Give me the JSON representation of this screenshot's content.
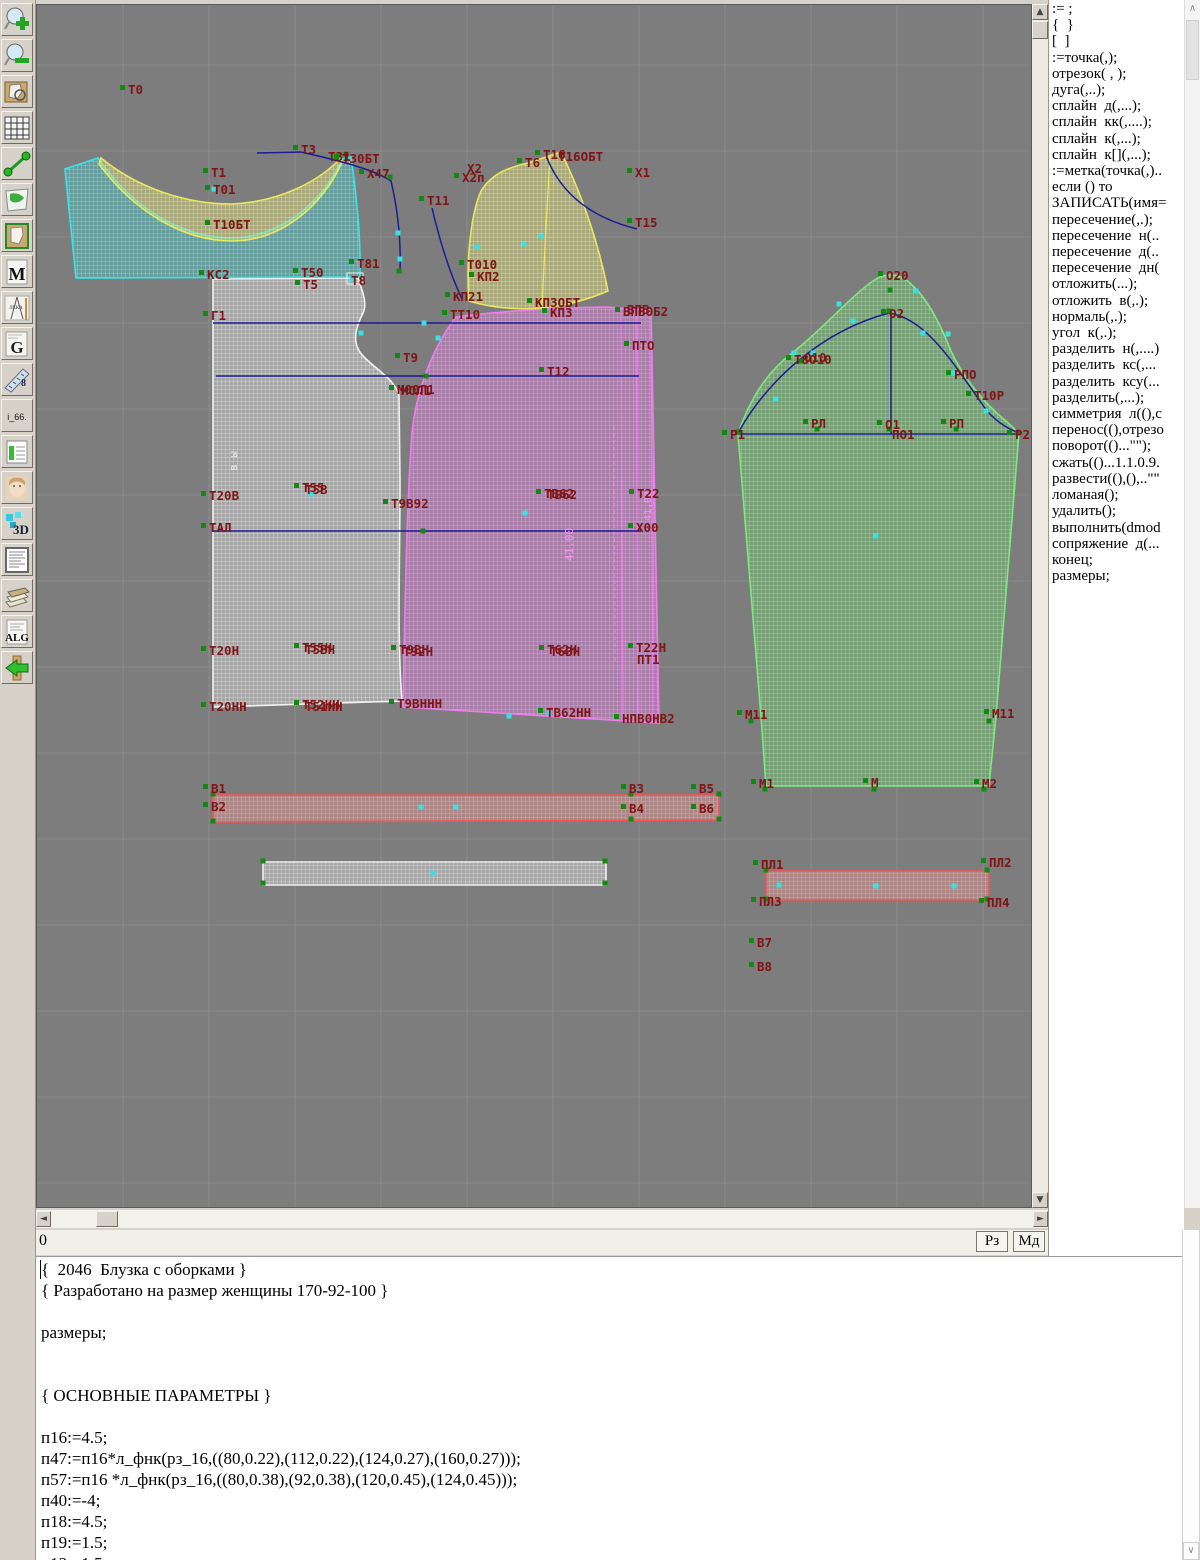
{
  "toolbar": {
    "icons": [
      {
        "name": "zoom-in-icon"
      },
      {
        "name": "zoom-out-icon"
      },
      {
        "name": "preview-icon"
      },
      {
        "name": "grid-icon"
      },
      {
        "name": "segment-icon"
      },
      {
        "name": "map-icon"
      },
      {
        "name": "pattern-icon"
      },
      {
        "name": "m-page-icon",
        "text": "M"
      },
      {
        "name": "drafting-icon"
      },
      {
        "name": "g-page-icon",
        "text": "G"
      },
      {
        "name": "ruler-icon",
        "text": "8"
      },
      {
        "name": "i66-icon",
        "text": "i_66."
      },
      {
        "name": "table-icon"
      },
      {
        "name": "photo-icon"
      },
      {
        "name": "threed-icon",
        "text": "3D"
      },
      {
        "name": "list-icon"
      },
      {
        "name": "books-icon"
      },
      {
        "name": "alg-icon",
        "text": "ALG"
      },
      {
        "name": "exit-icon"
      }
    ]
  },
  "panel": {
    "items": [
      ":= ;",
      "{  }",
      "[  ]",
      ":=точка(,);",
      "отрезок( , );",
      "дуга(,..);",
      "сплайн  д(,...);",
      "сплайн  кк(,....);",
      "сплайн  к(,...);",
      "сплайн  к[](,...);",
      ":=метка(точка(,)..",
      "если () то",
      "ЗАПИСАТЬ(имя=",
      "пересечение(,.);",
      "пересечение  н(..",
      "пересечение  д(..",
      "пересечение  дн(",
      "отложить(...);",
      "отложить  в(,.);",
      "нормаль(,.);",
      "угол  к(,.);",
      "разделить  н(,....)",
      "разделить  кс(,...",
      "разделить  ксу(...",
      "разделить(,...);",
      "симметрия  л((),с",
      "перенос((),отрезо",
      "поворот(()...\"\");",
      "сжать(()...1.1.0.9.",
      "развести((),(),..\"\"",
      "ломаная();",
      "удалить();",
      "выполнить(dmod",
      "сопряжение  д(...",
      "конец;",
      "размеры;"
    ]
  },
  "statusbar": {
    "left": "0",
    "rz": "Рз",
    "md": "Мд"
  },
  "editor": {
    "lines": [
      "{  2046  Блузка с оборками }",
      "{ Разработано на размер женщины 170-92-100 }",
      "",
      "размеры;",
      "",
      "",
      "{ ОСНОВНЫЕ ПАРАМЕТРЫ }",
      "",
      "п16:=4.5;",
      "п47:=п16*л_фнк(рз_16,((80,0.22),(112,0.22),(124,0.27),(160,0.27)));",
      "п57:=п16 *л_фнк(рз_16,((80,0.38),(92,0.38),(120,0.45),(124,0.45)));",
      "п40:=-4;",
      "п18:=4.5;",
      "п19:=1.5;",
      "п13:=1.5;"
    ]
  },
  "canvas": {
    "bg": "#7d7d7d",
    "grid": {
      "x0": 122,
      "y0": 64,
      "step": 86,
      "color": "#8b8b8b"
    },
    "label_color": "#811414",
    "point_color": "#128a12",
    "marker_color": "#39e2e2",
    "line_color": "#1c1c96",
    "pieces": [
      {
        "name": "back-piece",
        "stroke": "#f2f2f2",
        "base": "#c9c9c9",
        "mesh": "#ffffff",
        "path": "M212,278 L357,277 C363,294 366,304 362,312 C353,330 351,344 363,356 C377,370 393,378 398,394 L399,480 C399,560 396,640 401,700 L212,706 Z"
      },
      {
        "name": "front-piece",
        "stroke": "#f07df0",
        "base": "#cf7fcf",
        "mesh": "#f7bdf7",
        "path": "M455,316 C482,312 542,307 605,306 L650,309 L658,722 L402,706 C404,600 406,498 411,432 C415,390 432,346 455,316 Z"
      },
      {
        "name": "back-yoke-piece",
        "stroke": "#35e8e8",
        "base": "#4fb8b8",
        "mesh": "#aef5f5",
        "path": "M64,168 L97,157 C135,212 185,237 232,237 C280,235 322,202 341,158 L350,156 C356,198 360,240 359,276 L75,277 Z"
      },
      {
        "name": "collar-band-piece",
        "stroke": "#e8e860",
        "base": "#cfcf7a",
        "mesh": "#fafab4",
        "path": "M100,157 C138,188 186,203 230,203 C282,201 320,178 340,157 L341,161 C322,205 280,240 231,240 C184,240 134,212 98,163 Z"
      },
      {
        "name": "side-ruffle-piece",
        "stroke": "#e8e860",
        "base": "#cfcf7a",
        "mesh": "#fafab4",
        "path": "M527,162 L560,151 C580,192 597,240 607,290 C565,308 515,314 468,300 C465,258 470,213 480,190 C492,171 510,166 527,162 Z"
      },
      {
        "name": "sleeve-piece",
        "stroke": "#7fe87f",
        "base": "#6fbf6f",
        "mesh": "#b9f2b9",
        "path": "M737,433 C748,400 765,372 790,353 C820,330 850,295 872,280 C885,271 900,272 912,285 C928,300 940,325 950,350 C960,372 980,400 1005,420 L1018,432 L995,715 L988,785 L765,785 L760,715 Z"
      },
      {
        "name": "ruffle-strip-piece",
        "stroke": "#f25555",
        "base": "#d98f8f",
        "mesh": "#f7c0c0",
        "path": "M212,794 L718,794 L718,819 L212,821 Z"
      },
      {
        "name": "binding-strip-piece",
        "stroke": "#eeeeee",
        "base": "#cccccc",
        "mesh": "#f5f5f5",
        "path": "M262,861 L605,861 L605,884 L262,884 Z"
      },
      {
        "name": "cuff-strip-piece",
        "stroke": "#f25555",
        "base": "#d98f8f",
        "mesh": "#f7c0c0",
        "path": "M765,870 L988,870 L988,899 L765,899 Z"
      }
    ],
    "blue_lines": [
      [
        212,
        322,
        640,
        322
      ],
      [
        215,
        375,
        638,
        375
      ],
      [
        212,
        530,
        640,
        530
      ],
      [
        735,
        433,
        1020,
        433
      ],
      [
        890,
        312,
        890,
        433
      ],
      [
        256,
        152,
        300,
        151
      ]
    ],
    "fold_lines": {
      "color": "#f07df0",
      "solid": [
        [
          620,
          312,
          622,
          718
        ],
        [
          635,
          310,
          637,
          720
        ],
        [
          650,
          309,
          652,
          721
        ]
      ],
      "dashed": [
        [
          613,
          425,
          614,
          660
        ]
      ]
    },
    "blue_curves": [
      "M300,151 C340,160 374,169 390,180 C398,214 400,244 399,272",
      "M431,207 C440,245 450,275 461,298",
      "M546,157 C562,197 596,218 636,228",
      "M737,432 C766,380 820,330 888,312 C926,318 952,362 986,410 C998,423 1008,428 1018,432"
    ],
    "seam_curves": [
      {
        "d": "M549,154 C546,210 543,260 541,308",
        "color": "#e8e860"
      }
    ],
    "sel_rect": {
      "x": 346,
      "y": 272,
      "w": 16,
      "h": 11
    },
    "labels": [
      [
        "Т0",
        127,
        93
      ],
      [
        "Т3",
        300,
        153
      ],
      [
        "Т31",
        327,
        160,
        0
      ],
      [
        "Т30БТ",
        341,
        162
      ],
      [
        "Х47",
        366,
        177
      ],
      [
        "Т1",
        210,
        176
      ],
      [
        "Т01",
        212,
        193
      ],
      [
        "Т10БТ",
        212,
        228
      ],
      [
        "КС2",
        206,
        278
      ],
      [
        "Т50",
        300,
        276
      ],
      [
        "Т5",
        302,
        288
      ],
      [
        "Т81",
        356,
        267
      ],
      [
        "Т8",
        350,
        284,
        0
      ],
      [
        "Т6",
        524,
        166
      ],
      [
        "Т16",
        542,
        158
      ],
      [
        "Т16ОБТ",
        557,
        160,
        0
      ],
      [
        "Х2",
        466,
        172,
        0
      ],
      [
        "Х2п",
        461,
        181
      ],
      [
        "Х1",
        634,
        176
      ],
      [
        "Т11",
        426,
        204
      ],
      [
        "Т15",
        634,
        226
      ],
      [
        "Т010",
        466,
        268
      ],
      [
        "КП2",
        476,
        280
      ],
      [
        "КП21",
        452,
        300
      ],
      [
        "ТТ10",
        449,
        318
      ],
      [
        "КП3ОБТ",
        534,
        306
      ],
      [
        "КП3",
        549,
        316
      ],
      [
        "ВПВ0Б2",
        622,
        315
      ],
      [
        "ВПВ",
        626,
        313,
        0
      ],
      [
        "ПТО",
        631,
        349
      ],
      [
        "Г1",
        210,
        319
      ],
      [
        "Т9",
        402,
        361
      ],
      [
        "Т12",
        546,
        375
      ],
      [
        "М00Л1",
        396,
        393
      ],
      [
        "МОЛ1",
        400,
        394,
        0
      ],
      [
        "Т20В",
        208,
        499
      ],
      [
        "Т55",
        301,
        491
      ],
      [
        "Т5В",
        304,
        493,
        0
      ],
      [
        "Т9В92",
        390,
        507
      ],
      [
        "ТВ62",
        543,
        497
      ],
      [
        "ТБ62",
        546,
        498,
        0
      ],
      [
        "Т22",
        636,
        497
      ],
      [
        "ТАЛ",
        208,
        531
      ],
      [
        "Х00",
        635,
        531
      ],
      [
        "Т20Н",
        208,
        654
      ],
      [
        "Т55Н",
        301,
        651
      ],
      [
        "Т5ВН",
        304,
        653,
        0
      ],
      [
        "Т9ВН",
        398,
        653
      ],
      [
        "Т92Н",
        402,
        655,
        0
      ],
      [
        "Т62Н",
        546,
        653
      ],
      [
        "Т6ВН",
        549,
        655,
        0
      ],
      [
        "Т22Н",
        635,
        651
      ],
      [
        "ПТ1",
        636,
        663,
        0
      ],
      [
        "Т20НН",
        208,
        710
      ],
      [
        "Т52НН",
        301,
        708
      ],
      [
        "Т51НН",
        304,
        710,
        0
      ],
      [
        "Т9ВННН",
        396,
        707
      ],
      [
        "ТВ62НН",
        545,
        716
      ],
      [
        "НПВ0НВ2",
        621,
        722
      ],
      [
        "О20",
        885,
        279
      ],
      [
        "О2",
        888,
        317
      ],
      [
        "Т8О10",
        793,
        363
      ],
      [
        "О10",
        803,
        361,
        0
      ],
      [
        "РПО",
        953,
        378
      ],
      [
        "Т10Р",
        973,
        399
      ],
      [
        "Р1",
        729,
        438
      ],
      [
        "РЛ",
        810,
        427
      ],
      [
        "О1",
        884,
        428
      ],
      [
        "ПО1",
        891,
        438,
        0
      ],
      [
        "РП",
        948,
        427
      ],
      [
        "Р2",
        1014,
        438
      ],
      [
        "М11",
        744,
        718
      ],
      [
        "М11",
        991,
        717
      ],
      [
        "М1",
        758,
        787
      ],
      [
        "М",
        870,
        786
      ],
      [
        "М2",
        981,
        787
      ],
      [
        "В1",
        210,
        792
      ],
      [
        "В2",
        210,
        810
      ],
      [
        "В3",
        628,
        792
      ],
      [
        "В4",
        628,
        812
      ],
      [
        "В5",
        698,
        792
      ],
      [
        "В6",
        698,
        812
      ],
      [
        "ПЛ1",
        760,
        868
      ],
      [
        "ПЛ2",
        988,
        866
      ],
      [
        "ПЛ3",
        758,
        905
      ],
      [
        "ПЛ4",
        986,
        906
      ],
      [
        "В7",
        756,
        946
      ],
      [
        "В8",
        756,
        970
      ]
    ],
    "green_points": [
      [
        345,
        153
      ],
      [
        389,
        176
      ],
      [
        398,
        270
      ],
      [
        630,
        793
      ],
      [
        630,
        818
      ],
      [
        718,
        793
      ],
      [
        718,
        818
      ],
      [
        212,
        793
      ],
      [
        212,
        820
      ],
      [
        262,
        860
      ],
      [
        262,
        882
      ],
      [
        604,
        860
      ],
      [
        604,
        882
      ],
      [
        765,
        869
      ],
      [
        765,
        898
      ],
      [
        986,
        869
      ],
      [
        986,
        898
      ],
      [
        737,
        431
      ],
      [
        1017,
        431
      ],
      [
        888,
        310
      ],
      [
        889,
        289
      ],
      [
        873,
        788
      ],
      [
        800,
        360
      ],
      [
        816,
        428
      ],
      [
        888,
        428
      ],
      [
        955,
        428
      ],
      [
        750,
        720
      ],
      [
        988,
        720
      ],
      [
        764,
        788
      ],
      [
        983,
        788
      ],
      [
        425,
        375
      ],
      [
        422,
        530
      ]
    ],
    "teal_markers": [
      [
        213,
        188
      ],
      [
        423,
        322
      ],
      [
        360,
        332
      ],
      [
        437,
        337
      ],
      [
        310,
        493
      ],
      [
        524,
        512
      ],
      [
        540,
        235
      ],
      [
        875,
        535
      ],
      [
        432,
        872
      ],
      [
        420,
        806
      ],
      [
        455,
        806
      ],
      [
        875,
        885
      ],
      [
        778,
        884
      ],
      [
        953,
        885
      ],
      [
        775,
        398
      ],
      [
        812,
        352
      ],
      [
        852,
        320
      ],
      [
        922,
        332
      ],
      [
        952,
        372
      ],
      [
        985,
        410
      ],
      [
        793,
        352
      ],
      [
        838,
        303
      ],
      [
        915,
        290
      ],
      [
        947,
        333
      ],
      [
        397,
        232
      ],
      [
        399,
        258
      ],
      [
        476,
        246
      ],
      [
        523,
        243
      ],
      [
        508,
        715
      ],
      [
        548,
        712
      ],
      [
        351,
        279
      ]
    ],
    "vertical_texts": [
      {
        "t": "в ы",
        "x": 236,
        "y": 470,
        "color": "#e8e8e8",
        "size": 11
      },
      {
        "t": "41.00",
        "x": 572,
        "y": 560,
        "color": "#f398f3",
        "size": 11
      },
      {
        "t": "41.00",
        "x": 650,
        "y": 520,
        "color": "#f398f3",
        "size": 10
      }
    ]
  }
}
